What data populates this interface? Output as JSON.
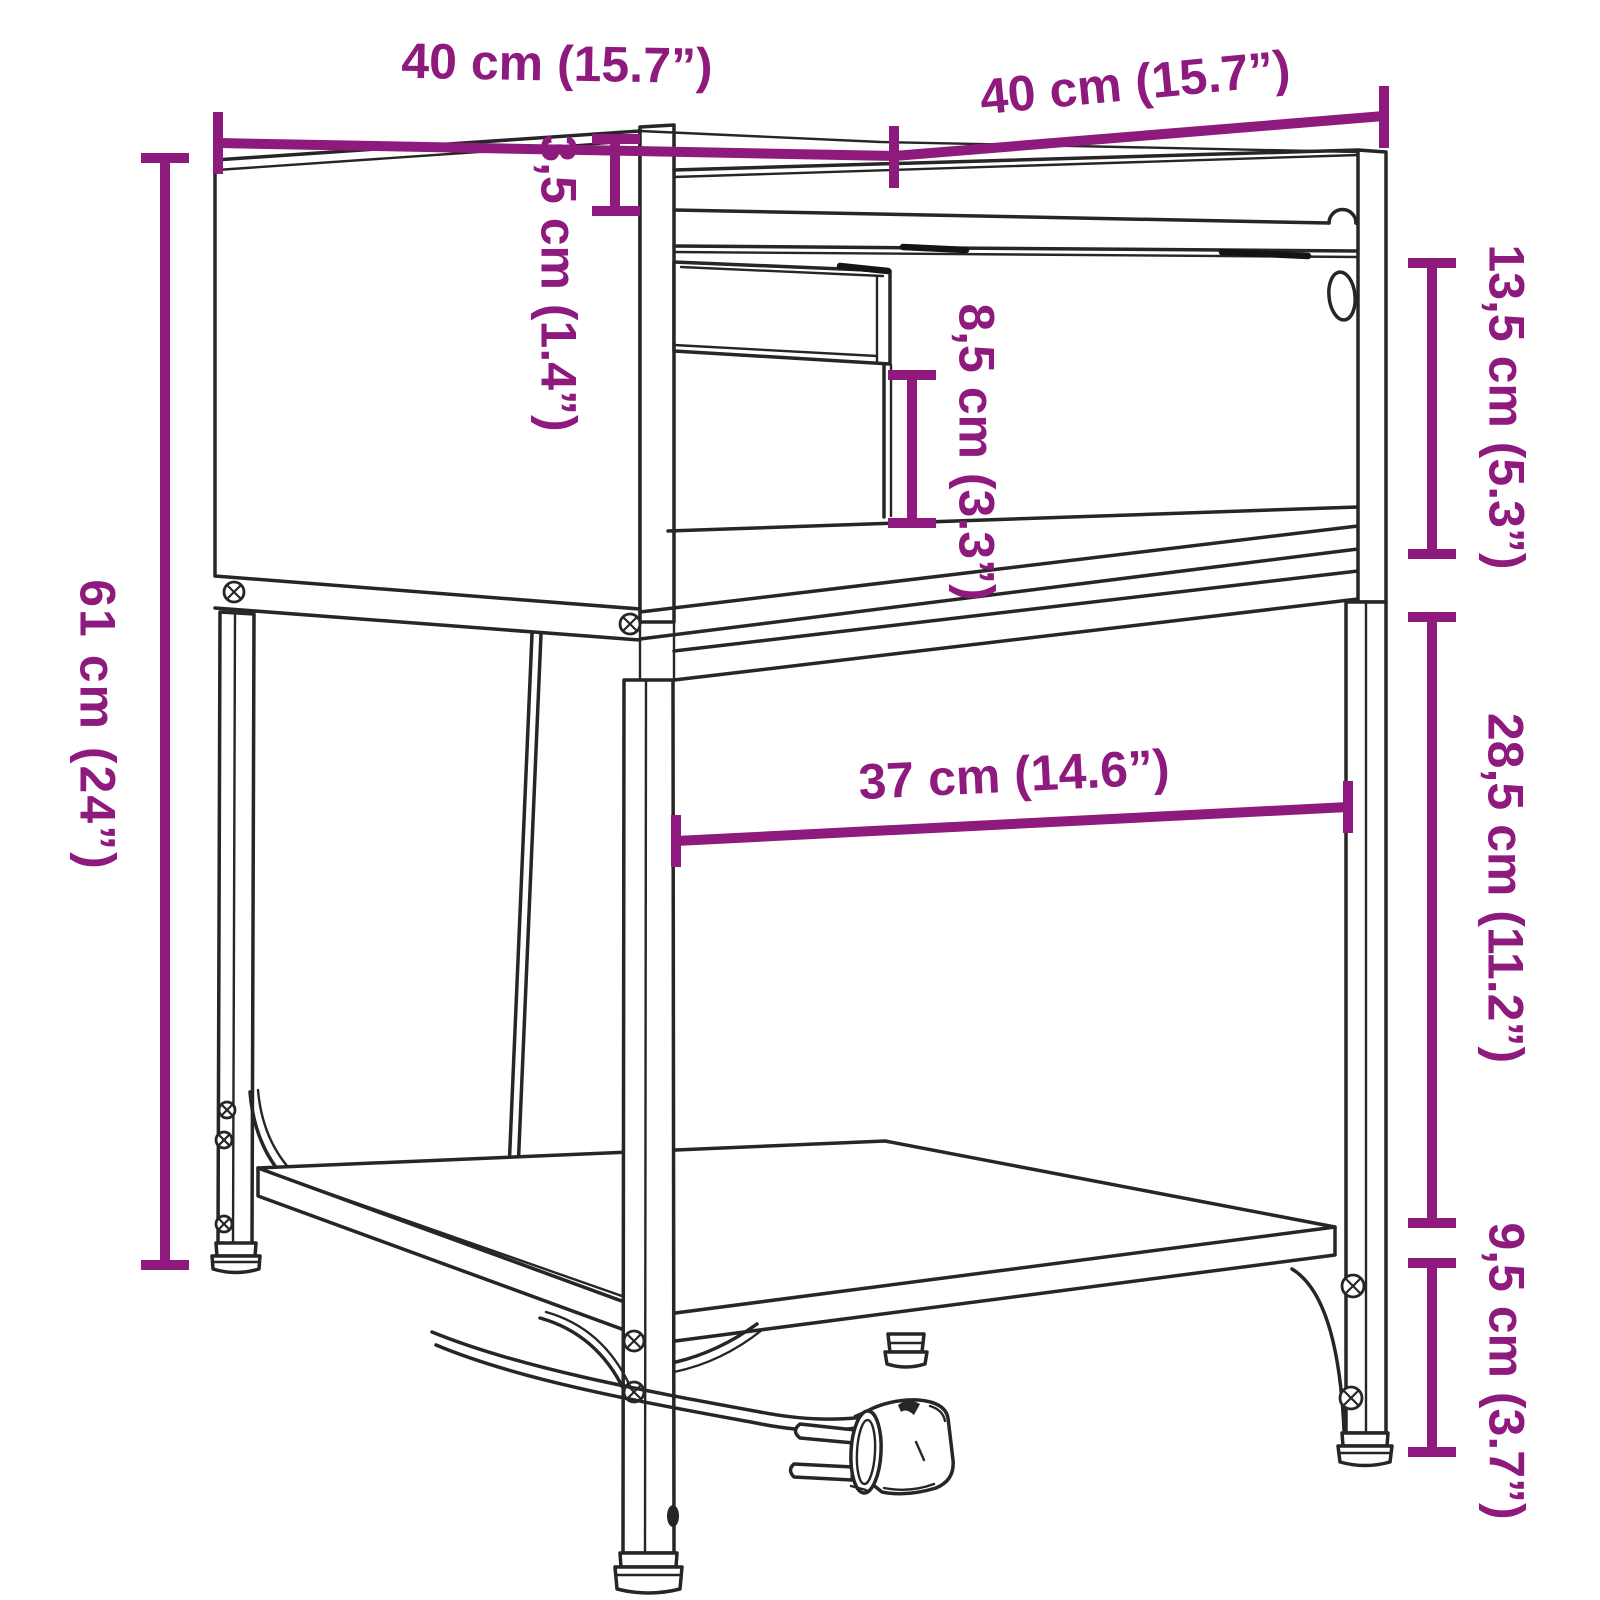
{
  "page": {
    "title": "Nightstand dimension diagram",
    "background": "#ffffff"
  },
  "style": {
    "accent_color": "#8d1a7c",
    "line_color": "#262626"
  },
  "dims": {
    "top_width": {
      "text": "40 cm (15.7”)"
    },
    "top_depth": {
      "text": "40 cm (15.7”)"
    },
    "top_thickness": {
      "text": "3,5 cm (1.4”)"
    },
    "upper_height": {
      "text": "13,5 cm (5.3”)"
    },
    "niche_height": {
      "text": "8,5 cm (3.3”)"
    },
    "frame_height": {
      "text": "61 cm (24”)"
    },
    "inner_width": {
      "text": "37 cm (14.6”)"
    },
    "leg_clearance": {
      "text": "28,5 cm (11.2”)"
    },
    "foot_height": {
      "text": "9,5 cm (3.7”)"
    }
  }
}
